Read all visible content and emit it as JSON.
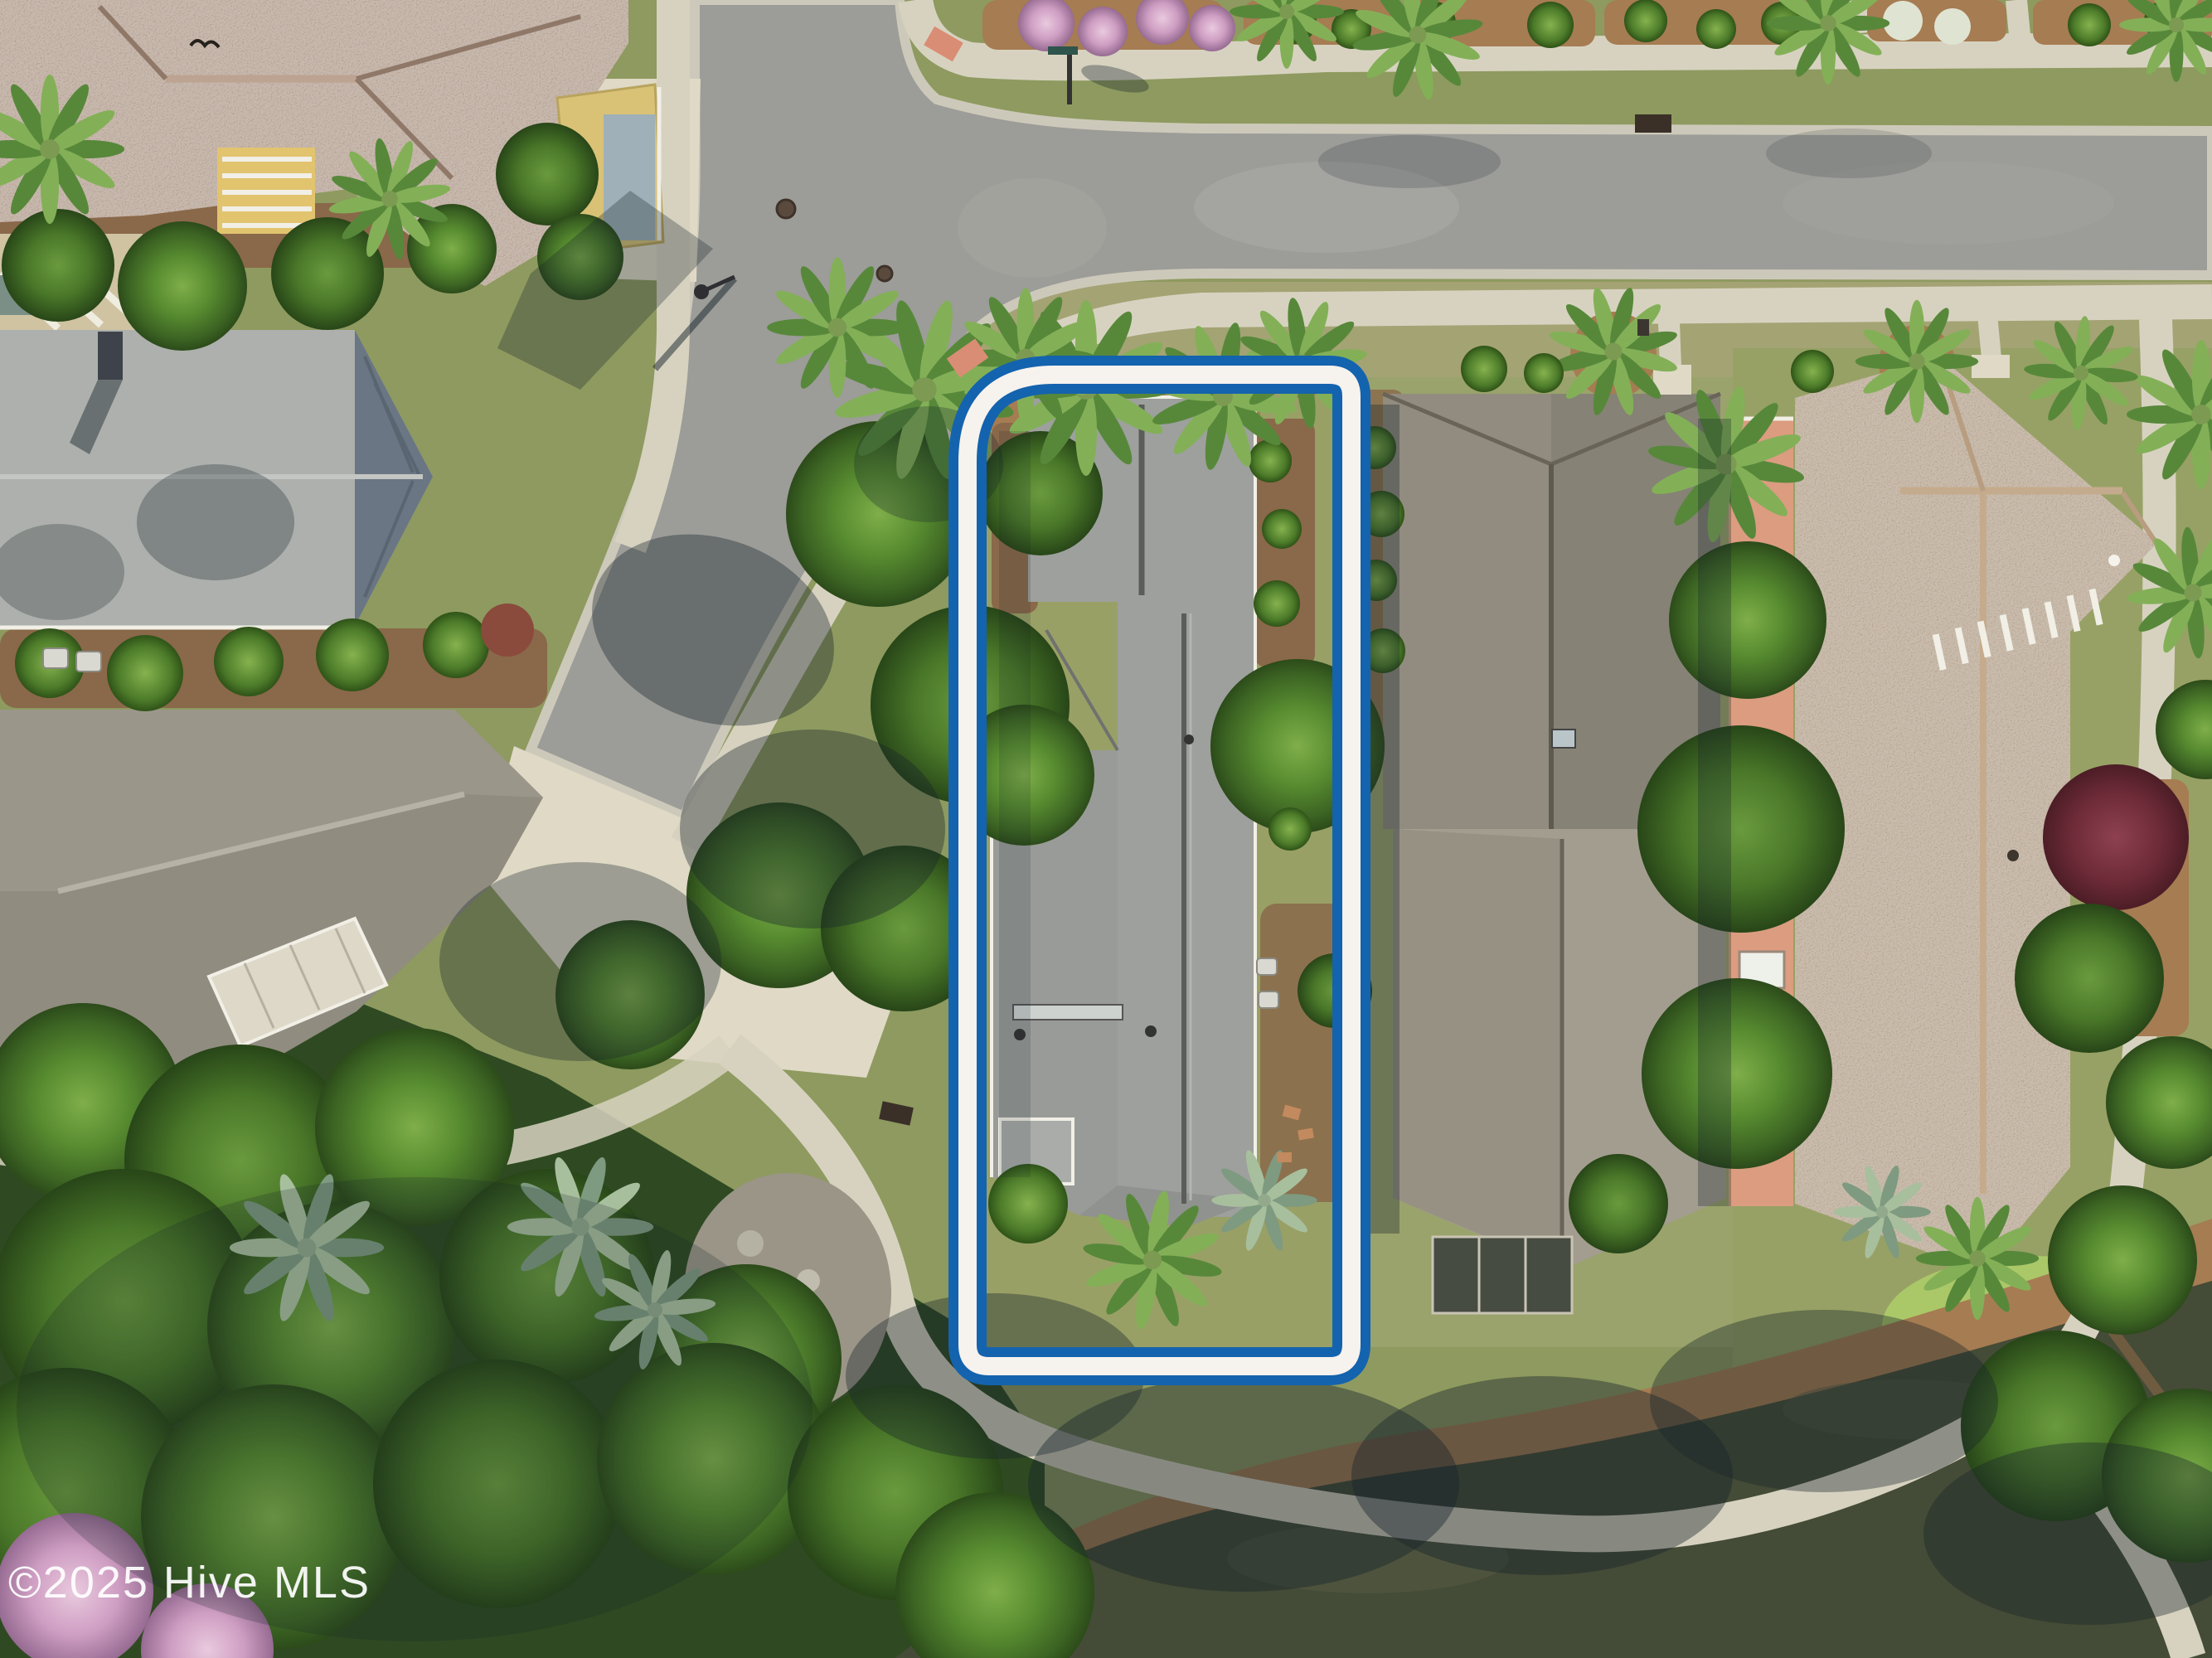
{
  "watermark": {
    "text": "©2025 Hive MLS"
  },
  "property_outline": {
    "style": "double blue line with white gap",
    "blue": "#1463ae",
    "white": "#f6f2ee"
  },
  "palette": {
    "outline_blue": "#1463ae",
    "outline_white": "#f6f2ee",
    "road": "#9c9c98",
    "road_light": "#abab a6",
    "curb": "#cdc9ba",
    "sidewalk": "#d7d2c0",
    "concrete": "#dfd9c6",
    "grass": "#8e9a5f",
    "grass_dry": "#a4a374",
    "lawn_bright": "#adcc68",
    "mulch": "#8a684a",
    "pinestraw": "#a67c52",
    "pond": "#444b36",
    "pond_light": "#555c44",
    "roof_subject": "#9da09c",
    "roof_topleft": "#a68e7d",
    "roof_left_mid": "#adb0ac",
    "roof_left_lower": "#908c80",
    "roof_f": "#918c7f",
    "roof_f_light": "#a39d8f",
    "roof_g": "#a9947c",
    "salmon": "#db9c80",
    "yellow_wall": "#e2c46f",
    "white_trim": "#f1efe6",
    "watermark": "#ffffff"
  }
}
